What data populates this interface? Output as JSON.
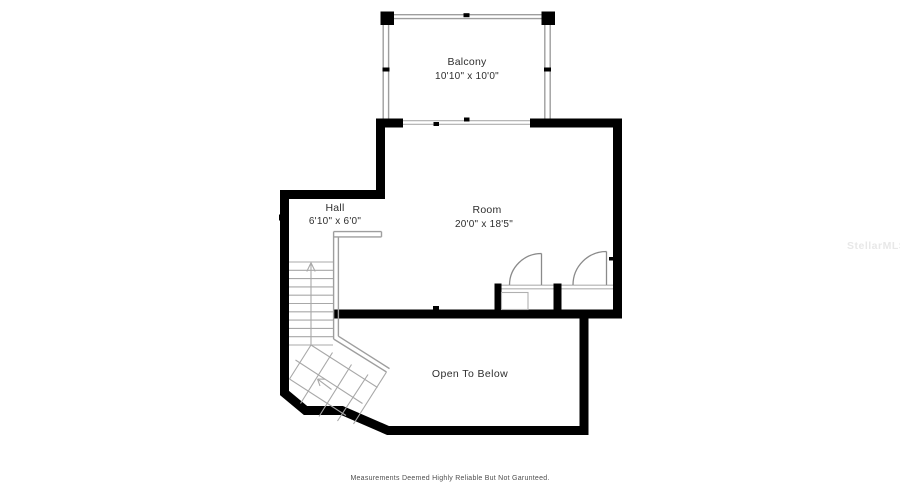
{
  "canvas": {
    "width": 900,
    "height": 500,
    "background": "#ffffff"
  },
  "colors": {
    "wall": "#000000",
    "thin_line": "#9e9e9e",
    "door_line": "#8a8a8a",
    "label_text": "#2e2e2e",
    "footer_text": "#4f4f4f",
    "watermark_text": "#e8e8e8"
  },
  "labels": {
    "balcony": {
      "name": "Balcony",
      "dims": "10'10\" x 10'0\""
    },
    "room": {
      "name": "Room",
      "dims": "20'0\" x 18'5\""
    },
    "hall": {
      "name": "Hall",
      "dims": "6'10\" x 6'0\""
    },
    "open_to_below": {
      "name": "Open To Below"
    }
  },
  "footer": {
    "text": "Measurements Deemed Highly Reliable But Not Garunteed."
  },
  "watermark": {
    "text": "StellarMLS"
  }
}
